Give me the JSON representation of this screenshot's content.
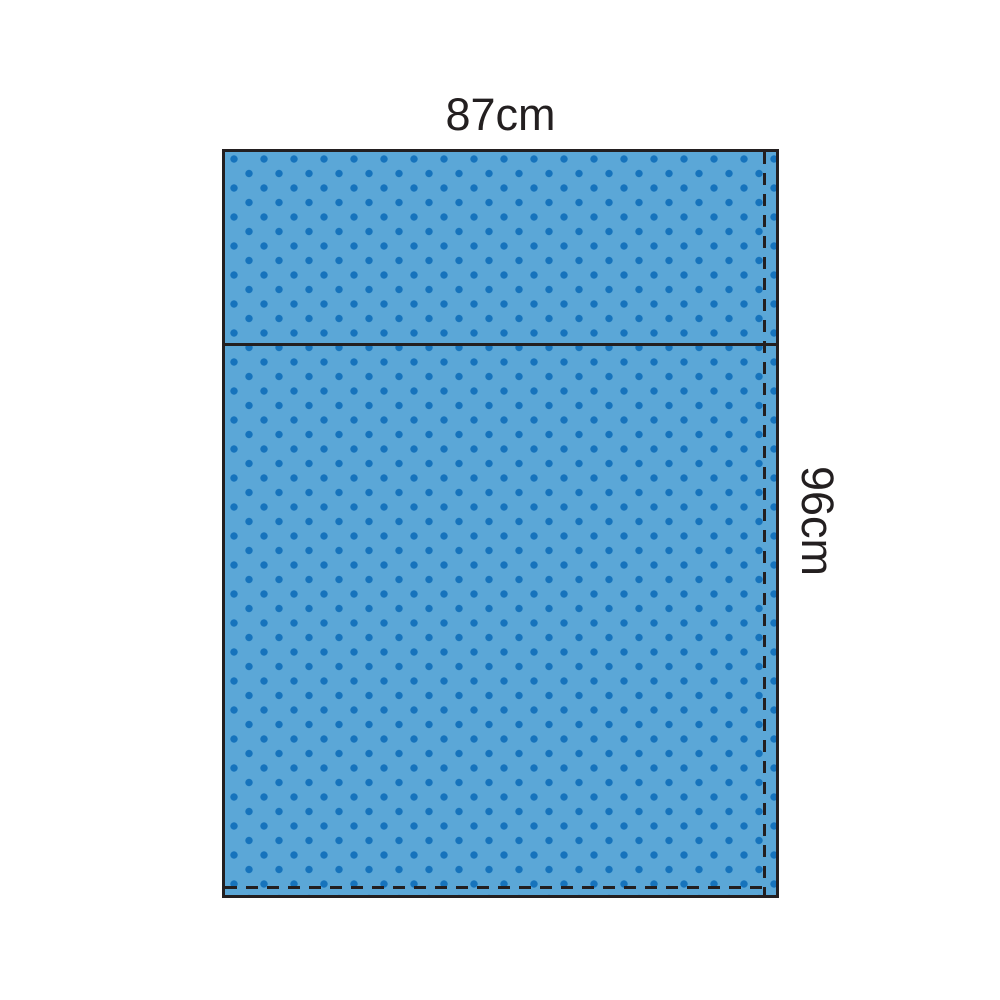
{
  "diagram": {
    "width_label": "87cm",
    "height_label": "96cm",
    "colors": {
      "drape_fill": "#5BA7D7",
      "dot": "#1673BC",
      "outline": "#231F20",
      "background": "#FFFFFF",
      "label_text": "#231F20"
    },
    "lines": {
      "fold_line_style": "solid",
      "right_perforation_style": "dashed",
      "bottom_perforation_style": "dashed"
    }
  }
}
